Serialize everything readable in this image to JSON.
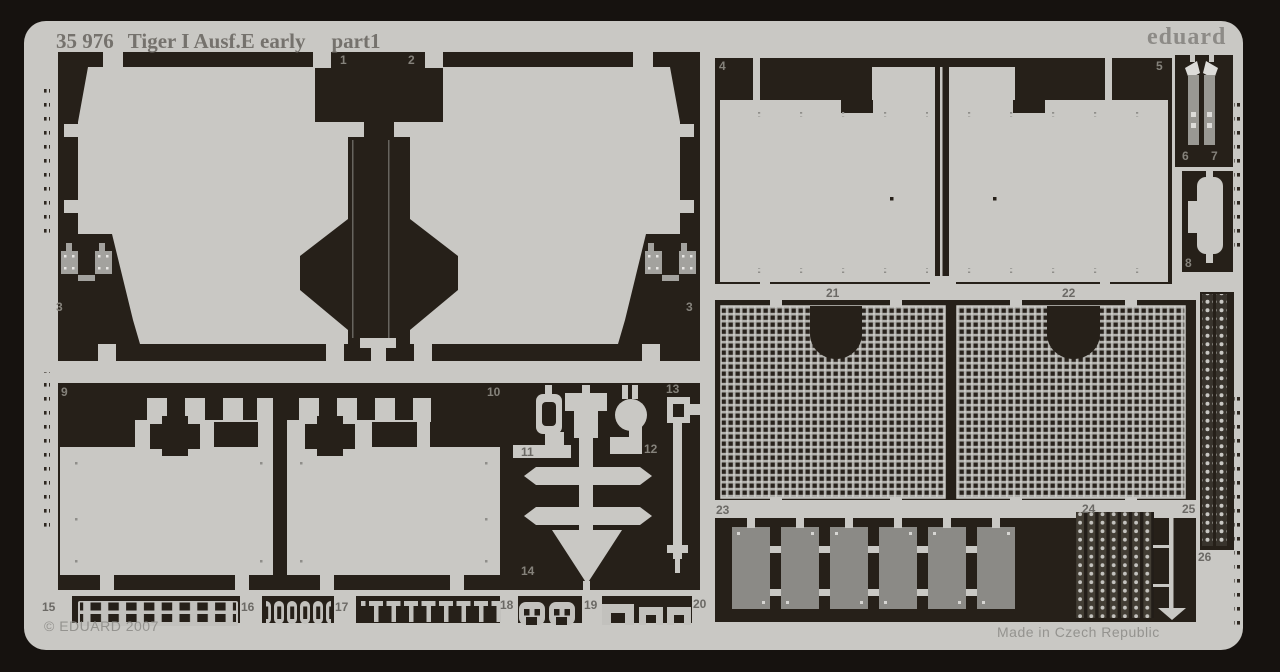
{
  "header": {
    "catalog_number": "35 976",
    "title": "Tiger I Ausf.E early",
    "part": "part1",
    "brand": "eduard"
  },
  "footer": {
    "copyright": "© EDUARD 2007",
    "made_in": "Made in Czech Republic"
  },
  "palette": {
    "background": "#16120f",
    "fret_metal": "#c9c8c4",
    "etched_cavity": "#262019",
    "part_mid_gray": "#9b9a96",
    "part_dark_gray": "#8b8a86",
    "label_on_black": "#85827b",
    "label_on_gray": "#6b6965"
  },
  "part_labels": {
    "p1": "1",
    "p2": "2",
    "p3": "3",
    "p4": "4",
    "p5": "5",
    "p6": "6",
    "p7": "7",
    "p8": "8",
    "p9": "9",
    "p10": "10",
    "p11": "11",
    "p12": "12",
    "p13": "13",
    "p14": "14",
    "p15": "15",
    "p16": "16",
    "p17": "17",
    "p18": "18",
    "p19": "19",
    "p20": "20",
    "p21": "21",
    "p22": "22",
    "p23": "23",
    "p24": "24",
    "p25": "25",
    "p26": "26"
  }
}
